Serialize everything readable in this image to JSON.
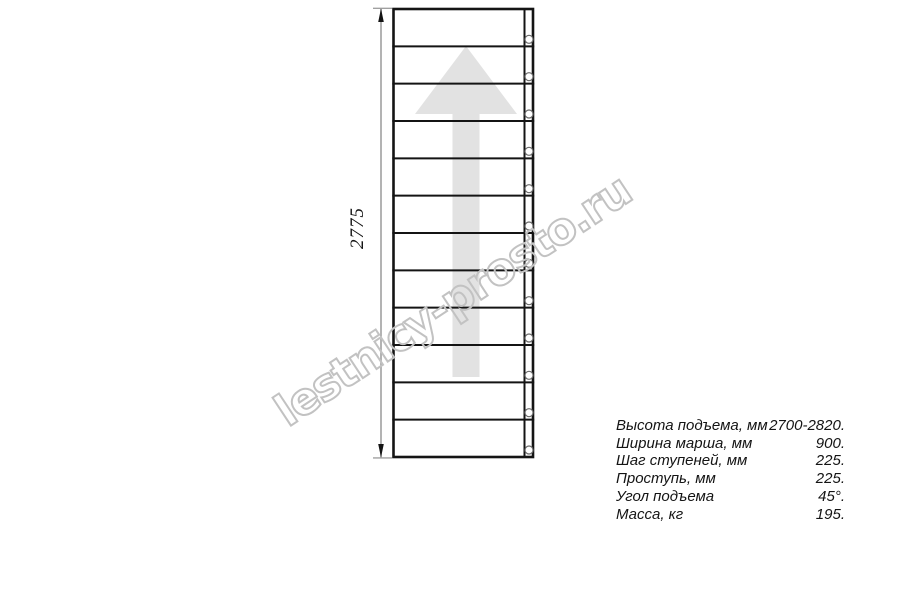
{
  "drawing": {
    "dimension_label": "2775",
    "steps_count": 12
  },
  "watermark": {
    "text": "lestnicy-prosto.ru"
  },
  "specs": {
    "rows": [
      {
        "label": "Высота подъема, мм",
        "value": "2700-2820."
      },
      {
        "label": "Ширина марша, мм",
        "value": "900."
      },
      {
        "label": "Шаг ступеней, мм",
        "value": "225."
      },
      {
        "label": "Проступь, мм",
        "value": "225."
      },
      {
        "label": "Угол подъема",
        "value": "45°."
      },
      {
        "label": "Масса, кг",
        "value": "195."
      }
    ]
  },
  "colors": {
    "line": "#141414",
    "dimension_line": "#a0a0a0",
    "arrow_fill": "#e2e2e2",
    "hole_stroke": "#6a6a6a",
    "watermark_stroke": "#c2c2c2",
    "text": "#141414"
  }
}
